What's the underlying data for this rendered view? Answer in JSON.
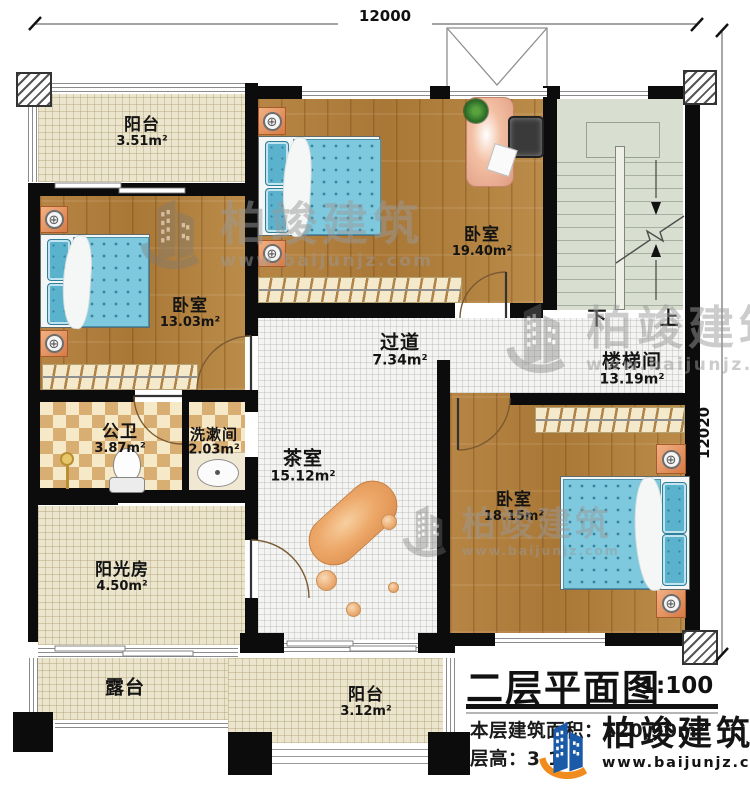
{
  "dimensions": {
    "top": "12000",
    "right": "12020"
  },
  "rooms": {
    "balcony_top": {
      "name": "阳台",
      "area": "3.51m²"
    },
    "bedroom_left": {
      "name": "卧室",
      "area": "13.03m²"
    },
    "bedroom_top": {
      "name": "卧室",
      "area": "19.40m²"
    },
    "corridor": {
      "name": "过道",
      "area": "7.34m²"
    },
    "stairwell": {
      "name": "楼梯间",
      "area": "13.19m²"
    },
    "bathroom": {
      "name": "公卫",
      "area": "3.87m²"
    },
    "washroom": {
      "name": "洗漱间",
      "area": "2.03m²"
    },
    "tea_room": {
      "name": "茶室",
      "area": "15.12m²"
    },
    "bedroom_right": {
      "name": "卧室",
      "area": "18.15m²"
    },
    "sunroom": {
      "name": "阳光房",
      "area": "4.50m²"
    },
    "terrace": {
      "name": "露台",
      "area": ""
    },
    "balcony_bottom": {
      "name": "阳台",
      "area": "3.12m²"
    }
  },
  "stairs": {
    "down_label": "下",
    "up_label": "上"
  },
  "title_block": {
    "title": "二层平面图",
    "scale": "1:100",
    "area_label": "本层建筑面积：",
    "area_value": "120.90m²",
    "height_label": "层高：",
    "height_value": "3.1"
  },
  "brand": {
    "name": "柏竣建筑",
    "website": "www.baijunjz.com"
  },
  "icons": {
    "lamp": "⊕"
  },
  "colors": {
    "wall": "#0c0c0c",
    "wood_floor": "#b08040",
    "bed_blue": "#7ec9de",
    "tile_cream": "#ece5cd",
    "bath_checker": "#d9ae72",
    "stair_green": "#d8ded0",
    "brand_blue": "#1a5aa6",
    "brand_orange": "#f08c1e"
  }
}
